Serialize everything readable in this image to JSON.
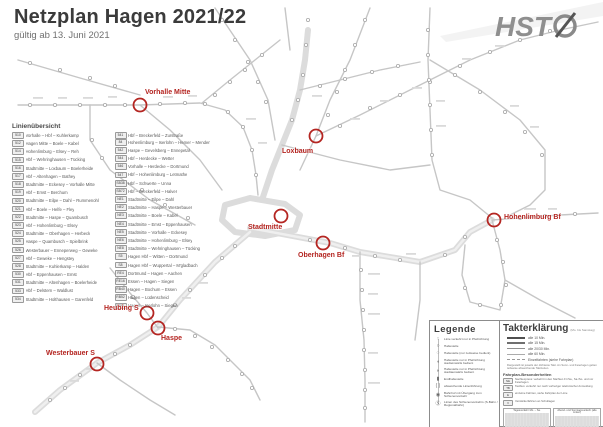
{
  "colors": {
    "accent_red": "#b42521",
    "route_gray": "#c9c9c9",
    "trunk_gray": "#dcdcdc",
    "title_gray": "#3b3b3b"
  },
  "header": {
    "title": "Netzplan Hagen 2021/22",
    "subtitle": "gültig ab 13. Juni 2021"
  },
  "logo": {
    "text": "HST"
  },
  "line_overview": {
    "title": "Linienübersicht",
    "left": [
      {
        "no": "510",
        "route": "Vorhalle – Hbf – Kuhlerkamp"
      },
      {
        "no": "512",
        "route": "Hagen Mitte – Boele – Kabel"
      },
      {
        "no": "514",
        "route": "Hohenlimburg – Elsey – Reh"
      },
      {
        "no": "515",
        "route": "Hbf – Wehringhausen – Tücking"
      },
      {
        "no": "516",
        "route": "Stadtmitte – Loxbaum – Boelerheide"
      },
      {
        "no": "517",
        "route": "Hbf – Altenhagen – Bathey"
      },
      {
        "no": "518",
        "route": "Stadtmitte – Eckesey – Vorhalle Mitte"
      },
      {
        "no": "519",
        "route": "Hbf – Emst – Berchum"
      },
      {
        "no": "520",
        "route": "Stadtmitte – Eilpe – Dahl – Rummenohl"
      },
      {
        "no": "521",
        "route": "Hbf – Boele – Helfe – Fley"
      },
      {
        "no": "522",
        "route": "Stadtmitte – Haspe – Quambusch"
      },
      {
        "no": "523",
        "route": "Hbf – Hohenlimburg – Elsey"
      },
      {
        "no": "524",
        "route": "Stadtmitte – Oberhagen – Herbeck"
      },
      {
        "no": "525",
        "route": "Haspe – Quambusch – Spielbrink"
      },
      {
        "no": "526",
        "route": "Westerbauer – Enneperweg – Geweke"
      },
      {
        "no": "527",
        "route": "Hbf – Geweke – Hengstey"
      },
      {
        "no": "528",
        "route": "Stadtmitte – Kuhlerkamp – Halden"
      },
      {
        "no": "530",
        "route": "Hbf – Eppenhausen – Emst"
      },
      {
        "no": "531",
        "route": "Stadtmitte – Altenhagen – Boelerheide"
      },
      {
        "no": "533",
        "route": "Hbf – Delstern – Waldlust"
      },
      {
        "no": "534",
        "route": "Stadtmitte – Holthausen – Garenfeld"
      },
      {
        "no": "541",
        "route": "Hbf – Breckerfeld – Zurstraße"
      }
    ],
    "right": [
      {
        "no": "84",
        "route": "Hohenlimburg – Iserlohn – Hemer – Menden"
      },
      {
        "no": "542",
        "route": "Haspe – Gevelsberg – Ennepetal"
      },
      {
        "no": "544",
        "route": "Hbf – Herdecke – Wetter"
      },
      {
        "no": "546",
        "route": "Vorhalle – Herdecke – Dortmund"
      },
      {
        "no": "547",
        "route": "Hbf – Hohenlimburg – Letmathe"
      },
      {
        "no": "SB38",
        "route": "Hbf – Schwerte – Unna"
      },
      {
        "no": "SB72",
        "route": "Hbf – Breckerfeld – Halver"
      },
      {
        "no": "NE1",
        "route": "Stadtmitte – Eilpe – Dahl"
      },
      {
        "no": "NE2",
        "route": "Stadtmitte – Haspe – Westerbauer"
      },
      {
        "no": "NE3",
        "route": "Stadtmitte – Boele – Kabel"
      },
      {
        "no": "NE4",
        "route": "Stadtmitte – Emst – Eppenhausen"
      },
      {
        "no": "NE5",
        "route": "Stadtmitte – Vorhalle – Eckesey"
      },
      {
        "no": "NE6",
        "route": "Stadtmitte – Hohenlimburg – Elsey"
      },
      {
        "no": "NE8",
        "route": "Stadtmitte – Wehringhausen – Tücking"
      },
      {
        "no": "S5",
        "route": "Hagen Hbf – Witten – Dortmund"
      },
      {
        "no": "S8",
        "route": "Hagen Hbf – Wuppertal – M'gladbach"
      },
      {
        "no": "RE4",
        "route": "Dortmund – Hagen – Aachen"
      },
      {
        "no": "RE16",
        "route": "Essen – Hagen – Siegen"
      },
      {
        "no": "RB40",
        "route": "Hagen – Bochum – Essen"
      },
      {
        "no": "RB52",
        "route": "Hagen – Lüdenscheid"
      },
      {
        "no": "RB91",
        "route": "Hagen – Iserlohn – Siegen"
      }
    ]
  },
  "highlights": [
    {
      "id": "vorhalle-mitte",
      "label": "Vorhalle Mitte"
    },
    {
      "id": "loxbaum",
      "label": "Loxbaum"
    },
    {
      "id": "stadtmitte",
      "label": "Stadtmitte"
    },
    {
      "id": "oberhagen-bf",
      "label": "Oberhagen Bf"
    },
    {
      "id": "heubing-s",
      "label": "Heubing S"
    },
    {
      "id": "haspe",
      "label": "Haspe"
    },
    {
      "id": "westerbauer-s",
      "label": "Westerbauer S"
    },
    {
      "id": "hohenlimburg-bf",
      "label": "Hohenlimburg Bf"
    }
  ],
  "legend": {
    "title": "Legende",
    "items": [
      {
        "glyph": "↑",
        "text": "Linie verkehrt nur in Pfeilrichtung"
      },
      {
        "glyph": "○",
        "text": "Haltestelle"
      },
      {
        "glyph": "◌",
        "text": "Haltestelle (nur zeitweise bedient)"
      },
      {
        "glyph": "◖",
        "text": "Haltestelle nur in Pfeilrichtung stadteinwärts bedient"
      },
      {
        "glyph": "◗",
        "text": "Haltestelle nur in Pfeilrichtung stadtauswärts bedient"
      },
      {
        "glyph": "▮",
        "text": "Endhaltestelle"
      },
      {
        "glyph": "( )",
        "text": "abweichende Linienführung"
      },
      {
        "glyph": "◉",
        "text": "Bahnhof mit Übergang zum Schienenverkehr"
      },
      {
        "glyph": "Ⓢ",
        "text": "Linien des Schienenverkehrs (S-Bahn / Regionalbahn)"
      }
    ]
  },
  "takt": {
    "title": "Takterklärung",
    "subtitle": "(Mo. bis Samstag)",
    "frequencies": [
      {
        "cls": "fb10",
        "label": "alle 10 Min."
      },
      {
        "cls": "fb15",
        "label": "alle 15 Min."
      },
      {
        "cls": "fb20",
        "label": "alle 20/30 Min."
      },
      {
        "cls": "fb60",
        "label": "alle 60 Min."
      },
      {
        "cls": "fbE",
        "label": "Einzelfahrten (siehe Fahrplan)"
      }
    ],
    "note": "Dargestellt ist jeweils der dichteste Takt. An Sonn- und Feiertagen gelten teilweise abweichende Taktzeiten.",
    "specials_title": "Fahrplan-Besonderheiten",
    "specials": [
      {
        "badge": "NE",
        "text": "Nachtexpress: verkehrt in den Nächten Fr./Sa., Sa./So. und vor Feiertagen"
      },
      {
        "badge": "TB",
        "text": "Taxibus: verkehrt nur nach vorheriger telefonischer Anmeldung"
      },
      {
        "badge": "E",
        "text": "einzelne Fahrten, siehe Fahrplan der Linie"
      },
      {
        "badge": "V",
        "text": "Verstärkerfahrten an Schultagen"
      }
    ],
    "boxes": [
      {
        "title": "Tagesverkehr Mo. – Sa."
      },
      {
        "title": "Abend- und Sonntagsverkehr (alle Linien)"
      }
    ],
    "footer": [
      {
        "line": "Herausgeber: Hagener Straßenbahn AG"
      },
      {
        "line": "Stand: 13. Juni 2021"
      }
    ]
  }
}
